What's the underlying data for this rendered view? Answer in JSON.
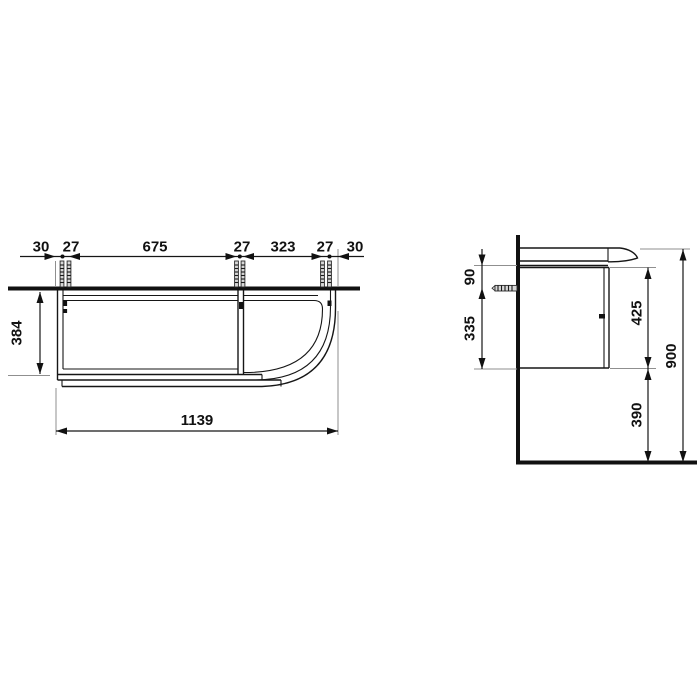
{
  "meta": {
    "description": "Technical dimension drawing of a wall-mounted vanity unit with washbasin: top (plan) view at left, side (section) view at right",
    "units": "mm"
  },
  "colors": {
    "background": "#ffffff",
    "line": "#161616",
    "extension_line": "#8f8f8f",
    "text": "#111111"
  },
  "top_view": {
    "label": "top-view",
    "dims": {
      "edge_left": "30",
      "pair_left": "27",
      "span_main": "675",
      "pair_mid": "27",
      "span_right": "323",
      "pair_right": "27",
      "edge_right": "30",
      "depth": "384",
      "overall_width": "1139"
    }
  },
  "side_view": {
    "label": "side-view",
    "dims": {
      "basin_to_anchor": "90",
      "anchor_to_bottom": "335",
      "cabinet_height": "425",
      "floor_clearance": "390",
      "overall_height": "900"
    }
  }
}
